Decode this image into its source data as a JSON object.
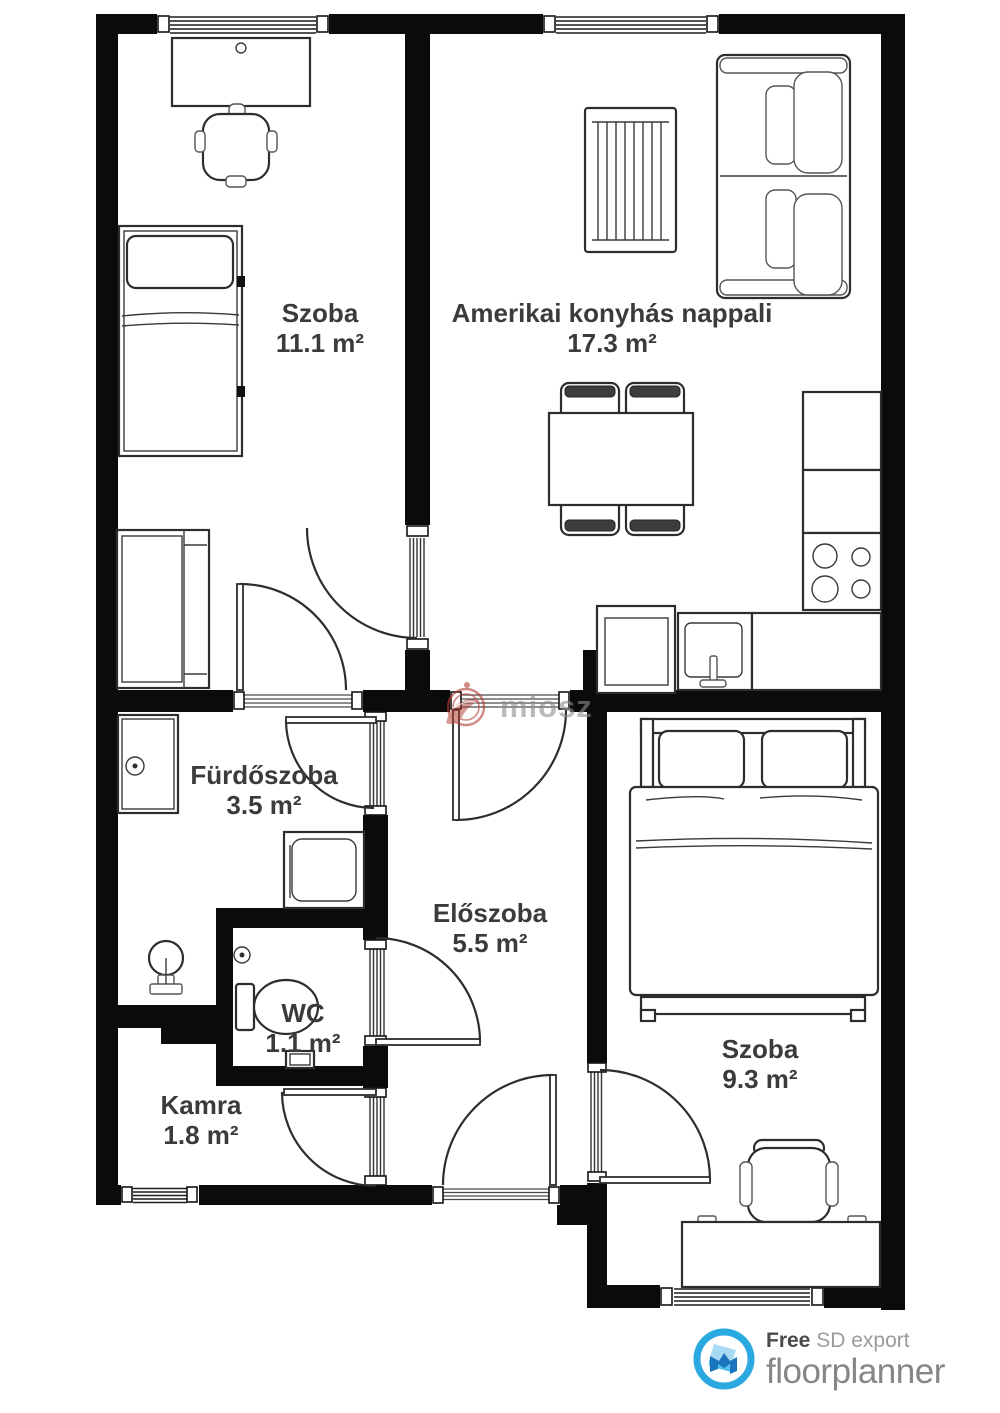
{
  "title": "Floor plan export",
  "rooms": [
    {
      "id": "szoba-1",
      "name": "Szoba",
      "area": "11.1 m²"
    },
    {
      "id": "nappali",
      "name": "Amerikai konyhás nappali",
      "area": "17.3 m²"
    },
    {
      "id": "furdoszoba",
      "name": "Fürdőszoba",
      "area": "3.5 m²"
    },
    {
      "id": "eloszoba",
      "name": "Előszoba",
      "area": "5.5 m²"
    },
    {
      "id": "wc",
      "name": "WC",
      "area": "1.1 m²"
    },
    {
      "id": "kamra",
      "name": "Kamra",
      "area": "1.8 m²"
    },
    {
      "id": "szoba-2",
      "name": "Szoba",
      "area": "9.3 m²"
    }
  ],
  "watermark": {
    "text": "miosz"
  },
  "footer": {
    "free": "Free",
    "tagline": "SD export",
    "brand": "floorplanner"
  },
  "colors": {
    "wall": "#0b0b0b",
    "furniture_line": "#2d2d2d",
    "label_text": "#3b3b3b",
    "watermark_red": "#b23b30",
    "watermark_gray": "#8d8d8d",
    "brand_blue": "#2aa9e0",
    "brand_dark_blue": "#1b75bc",
    "footer_free": "#4a4a4a",
    "footer_muted": "#9b9b9b",
    "footer_brand": "#868686"
  }
}
